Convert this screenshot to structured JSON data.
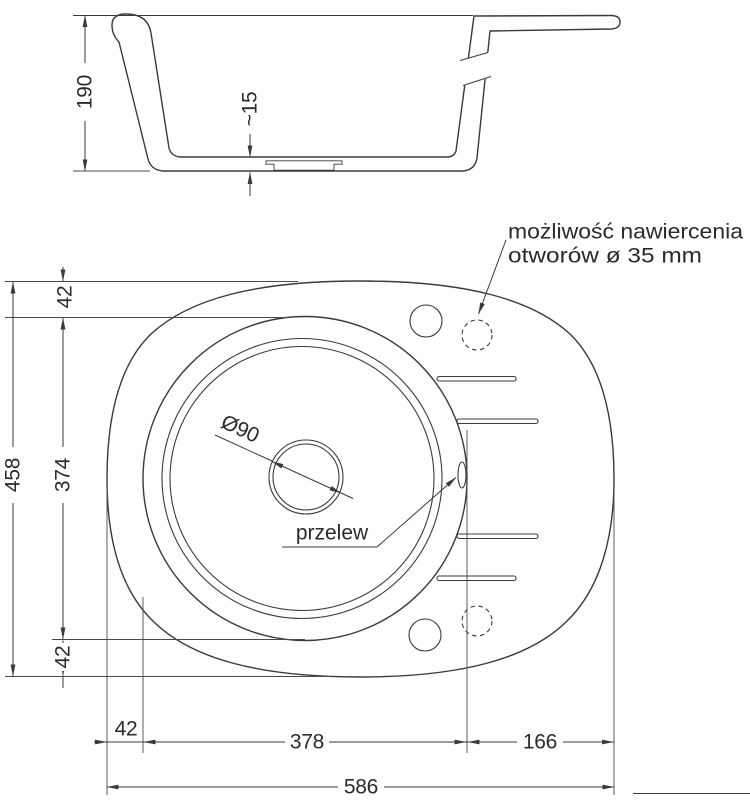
{
  "drawing": {
    "section": {
      "depth": "190",
      "base_thickness": "~15"
    },
    "plan": {
      "total_length": "458",
      "bowl_length": "374",
      "edge_offset_top": "42",
      "edge_offset_bottom": "42",
      "edge_offset_left": "42",
      "bowl_width": "378",
      "wing_width": "166",
      "total_width": "586",
      "drain_diameter": "Ø90",
      "overflow_label": "przelew",
      "drill_note_line1": "możliwość nawiercenia",
      "drill_note_line2": "otworów ø 35 mm"
    },
    "colors": {
      "line": "#3a3a3a",
      "background": "#ffffff"
    }
  }
}
